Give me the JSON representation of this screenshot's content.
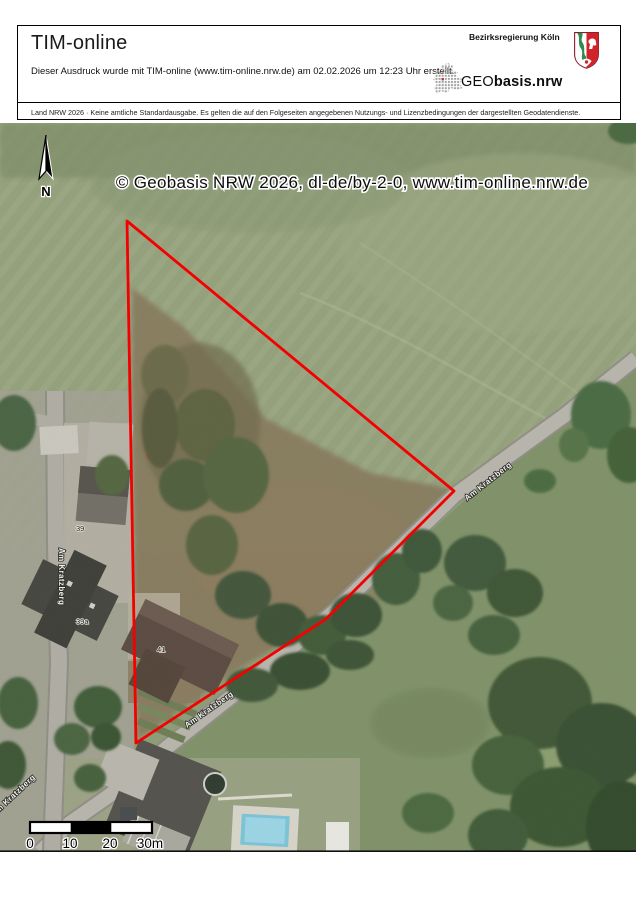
{
  "header": {
    "title": "TIM-online",
    "created_text": "Dieser Ausdruck wurde mit TIM-online (www.tim-online.nrw.de) am 02.02.2026 um 12:23 Uhr erstellt.",
    "agency": "Bezirksregierung Köln",
    "logo_prefix": "GEO",
    "logo_suffix": "basis.nrw",
    "disclaimer": "Land NRW 2026 · Keine amtliche Standardausgabe. Es gelten die auf den Folgeseiten angegebenen Nutzungs- und Lizenzbedingungen der dargestellten Geodatendienste."
  },
  "map": {
    "copyright": "© Geobasis NRW 2026, dl-de/by-2-0, www.tim-online.nrw.de",
    "north_label": "N",
    "street_label": "Am Kratzberg",
    "house_numbers": [
      "39",
      "39a",
      "41"
    ],
    "boundary_color": "#f40000",
    "scale": {
      "labels": [
        "0",
        "10",
        "20",
        "30m"
      ]
    }
  }
}
